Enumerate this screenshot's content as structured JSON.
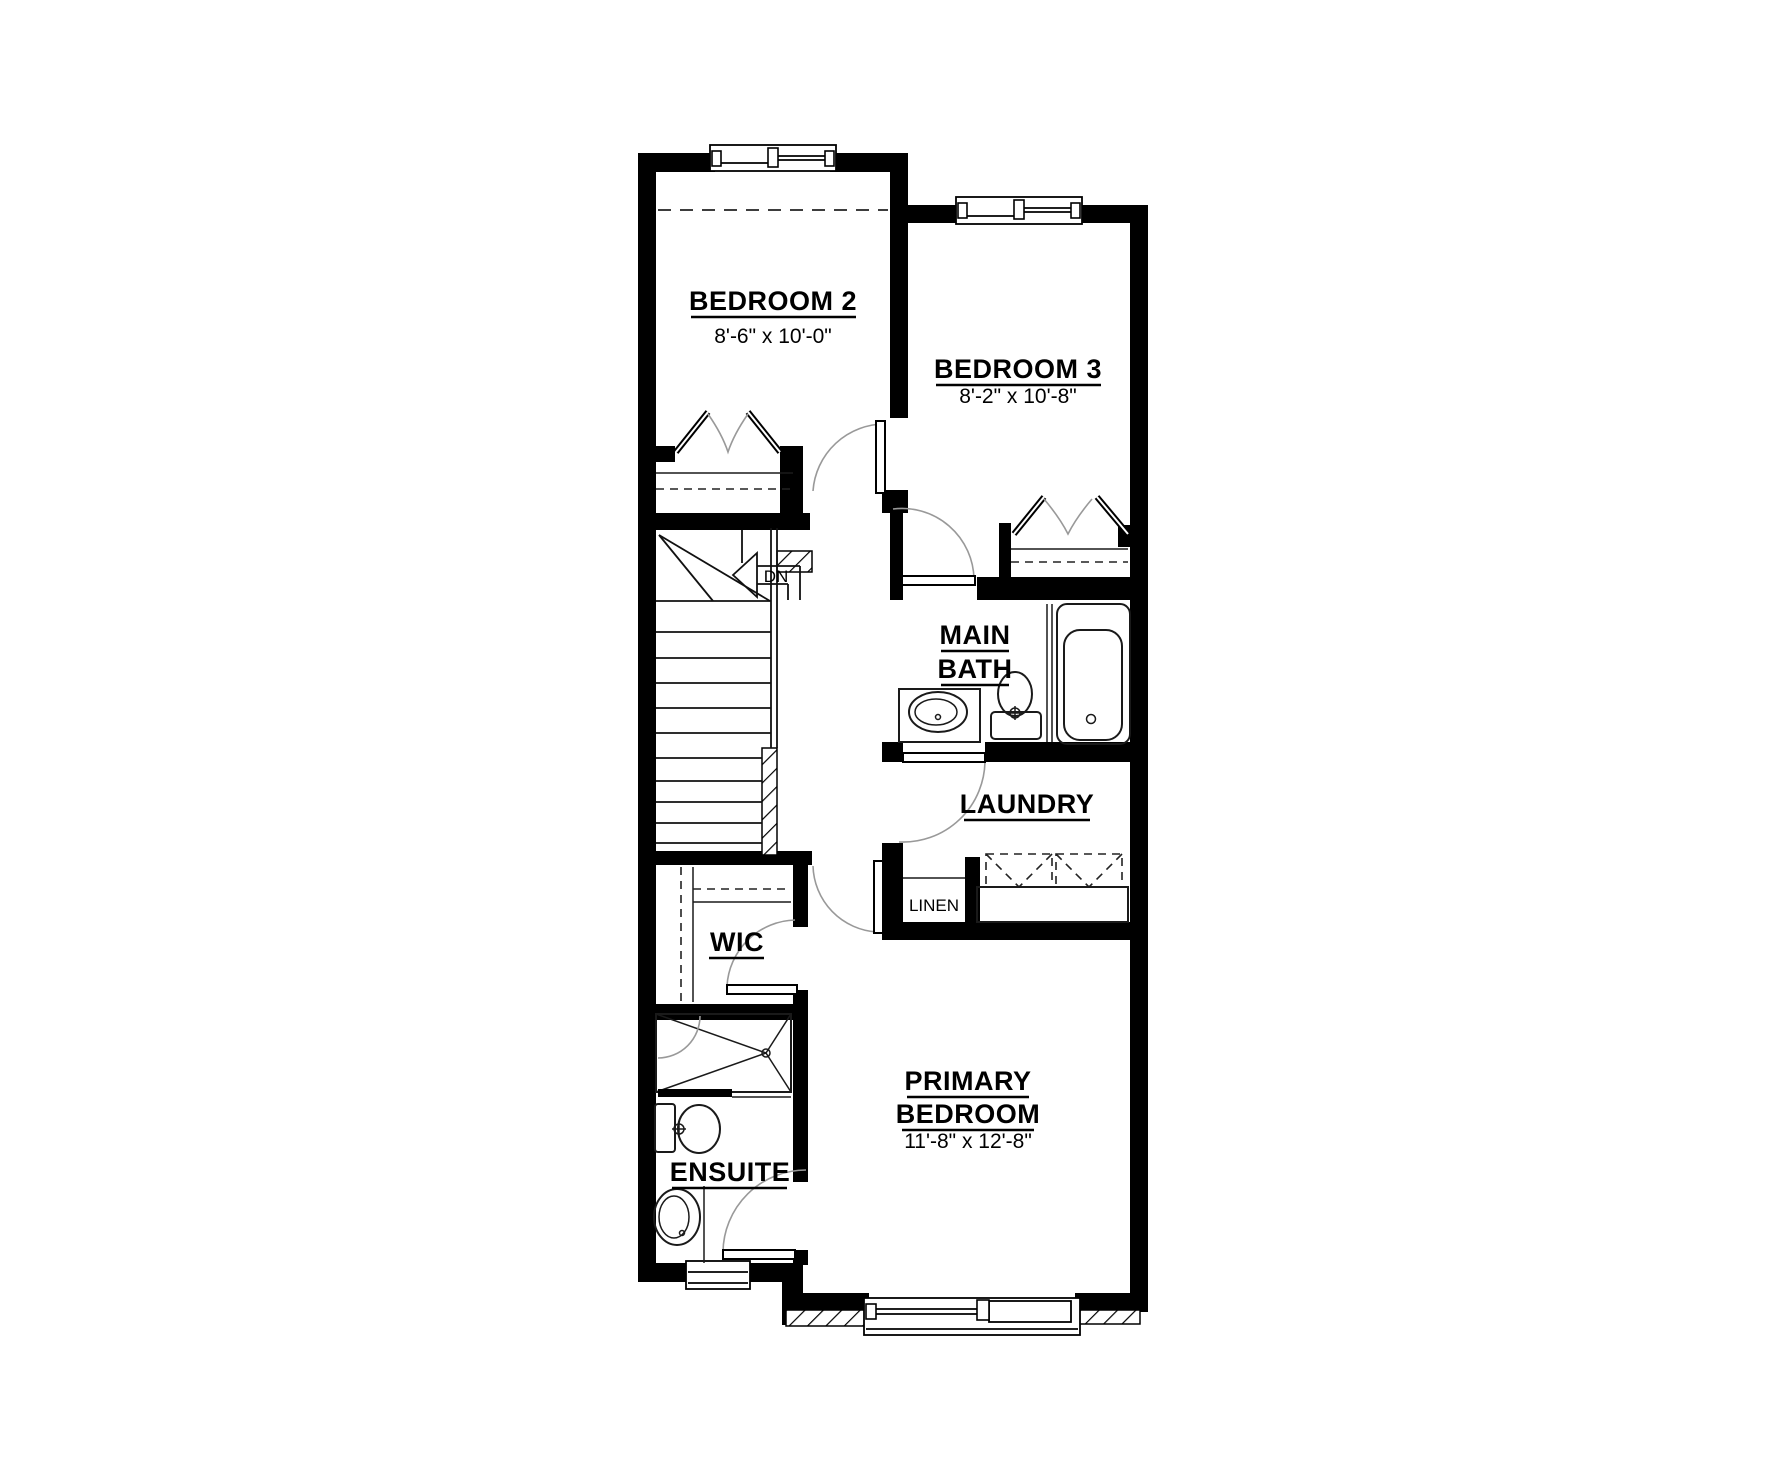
{
  "plan": {
    "title": "Second floor residential floor plan",
    "rooms": {
      "bedroom2": {
        "name": "BEDROOM 2",
        "dims": "8'-6\" x 10'-0\""
      },
      "bedroom3": {
        "name": "BEDROOM 3",
        "dims": "8'-2\" x 10'-8\""
      },
      "main_bath": {
        "name_line1": "MAIN",
        "name_line2": "BATH"
      },
      "laundry": {
        "name": "LAUNDRY"
      },
      "linen": {
        "name": "LINEN"
      },
      "wic": {
        "name": "WIC"
      },
      "primary_bedroom": {
        "name_line1": "PRIMARY",
        "name_line2": "BEDROOM",
        "dims": "11'-8\" x 12'-8\""
      },
      "ensuite": {
        "name": "ENSUITE"
      }
    },
    "stairs": {
      "label": "DN"
    },
    "colors": {
      "background": "#ffffff",
      "walls": "#000000",
      "door_arc": "#999999",
      "fixture_line": "#1a1a1a"
    }
  }
}
